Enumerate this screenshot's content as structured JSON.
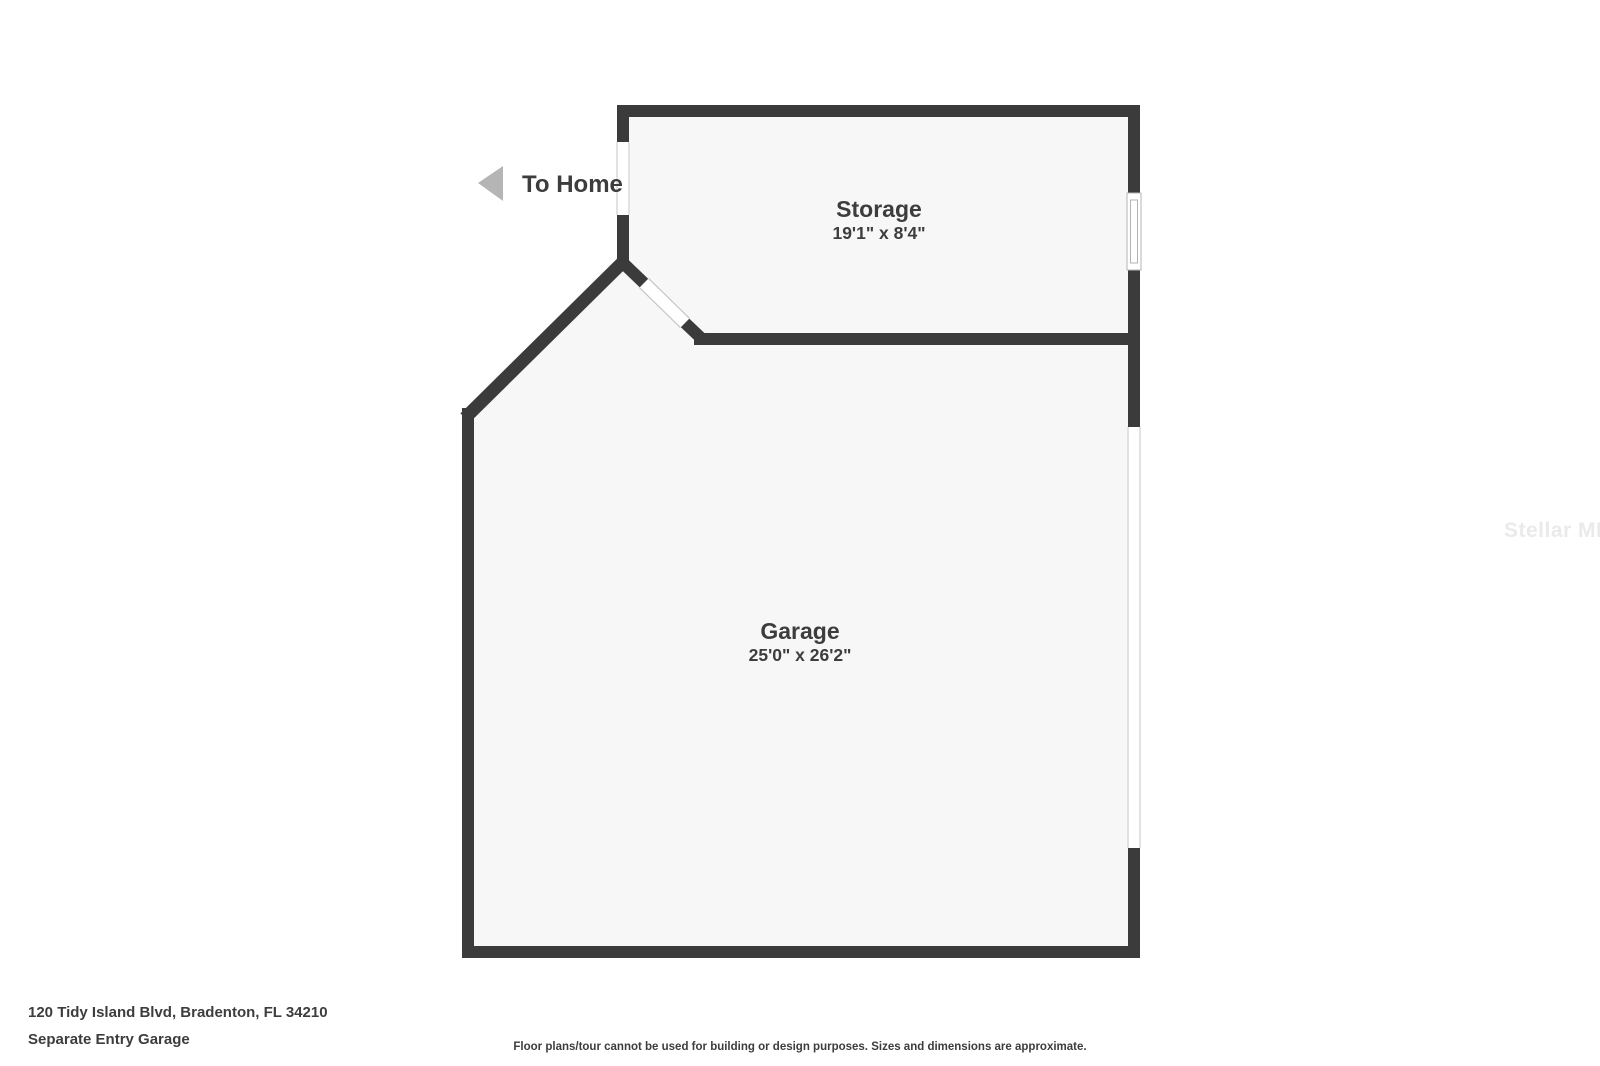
{
  "floor_plan": {
    "to_home_label": "To Home",
    "rooms": [
      {
        "name": "Storage",
        "dimensions": "19'1\" x 8'4\""
      },
      {
        "name": "Garage",
        "dimensions": "25'0\" x 26'2\""
      }
    ]
  },
  "footer": {
    "address": "120 Tidy Island Blvd, Bradenton, FL 34210",
    "subtitle": "Separate Entry Garage",
    "disclaimer": "Floor plans/tour cannot be used for building or design purposes. Sizes and dimensions are approximate."
  },
  "watermark": "Stellar MLS",
  "colors": {
    "wall": "#3b3b3b",
    "room_fill": "#f7f7f7",
    "text": "#3d3d3d",
    "arrow": "#b5b5b5",
    "jamb_line": "#c6c6c6",
    "watermark": "#eaeaea"
  }
}
